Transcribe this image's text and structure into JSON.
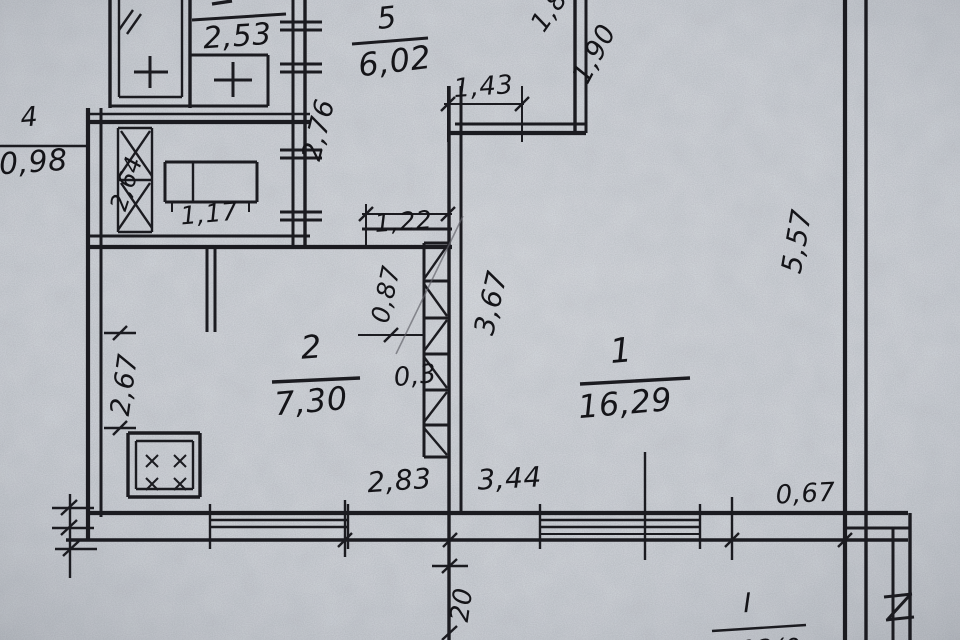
{
  "colors": {
    "paper": "#d6dadf",
    "ink": "#1b1b20",
    "pencil": "#5d5d66"
  },
  "labels": {
    "room1_number": "1",
    "room1_area": "16,29",
    "room2_number": "2",
    "room2_area": "7,30",
    "room3_area": "2,53",
    "room4_number": "4",
    "room4_area": "0,98",
    "room5_number": "5",
    "room5_area": "6,02",
    "dim_276": "2,76",
    "dim_143": "1,43",
    "dim_18": "1,8",
    "dim_190": "1,90",
    "dim_557": "5,57",
    "dim_264": "2,64",
    "dim_117": "1,17",
    "dim_122": "1,22",
    "dim_087": "0,87",
    "dim_367": "3,67",
    "dim_03": "0,3",
    "dim_267": "2,67",
    "dim_283": "2,83",
    "dim_344": "3,44",
    "dim_067": "0,67",
    "dim_20": "20",
    "balcony_roman": "I",
    "balcony_area_partial": "0,12(0,"
  }
}
